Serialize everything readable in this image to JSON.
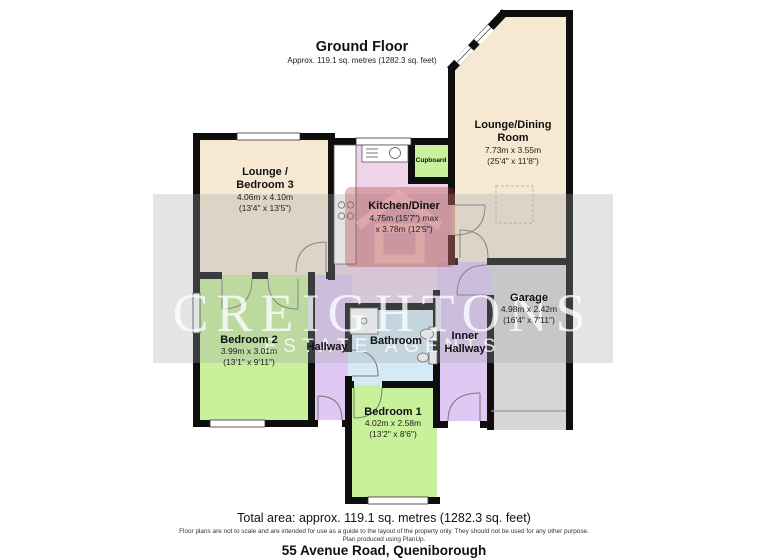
{
  "header": {
    "title": "Ground Floor",
    "subtitle": "Approx. 119.1 sq. metres (1282.3 sq. feet)"
  },
  "rooms": {
    "lounge_dining": {
      "line1": "Lounge/Dining",
      "line2": "Room",
      "metric": "7.73m x 3.55m",
      "imperial": "(25'4\" x 11'8\")"
    },
    "lounge_bedroom3": {
      "line1": "Lounge /",
      "line2": "Bedroom 3",
      "metric": "4.06m x 4.10m",
      "imperial": "(13'4\" x 13'5\")"
    },
    "kitchen": {
      "line1": "Kitchen/Diner",
      "metric": "4.75m (15'7\") max",
      "imperial": "x 3.78m (12'5\")"
    },
    "cupboard": {
      "line1": "Cupboard"
    },
    "bedroom2": {
      "line1": "Bedroom 2",
      "metric": "3.99m x 3.01m",
      "imperial": "(13'1\" x 9'11\")"
    },
    "hallway": {
      "line1": "Hallway"
    },
    "bathroom": {
      "line1": "Bathroom"
    },
    "inner_hallway": {
      "line1": "Inner",
      "line2": "Hallway"
    },
    "garage": {
      "line1": "Garage",
      "metric": "4.98m x 2.42m",
      "imperial": "(16'4\" x 7'11\")"
    },
    "bedroom1": {
      "line1": "Bedroom 1",
      "metric": "4.02m x 2.58m",
      "imperial": "(13'2\" x 8'6\")"
    }
  },
  "watermark": {
    "brand": "CREIGHTONS",
    "tagline": "ESTATE AGENTS"
  },
  "footer": {
    "total_area": "Total area: approx. 119.1 sq. metres (1282.3 sq. feet)",
    "disclaimer1": "Floor plans are not to scale and are intended for use as a guide to the layout of the property only. They should not be used for any other purpose.",
    "disclaimer2": "Plan produced using PlanUp.",
    "address": "55 Avenue Road, Queniborough"
  },
  "colors": {
    "beige": "#F7E9D1",
    "pink": "#EFD4E9",
    "green": "#C9F09B",
    "purple": "#E1C7F3",
    "blue": "#D5EAF5",
    "gray": "#D6D6D6",
    "wall": "#0E0E0E",
    "watermark_band": "#9FA6AC",
    "watermark_text": "#FFFFFF",
    "logo_red": "#B33A35"
  }
}
